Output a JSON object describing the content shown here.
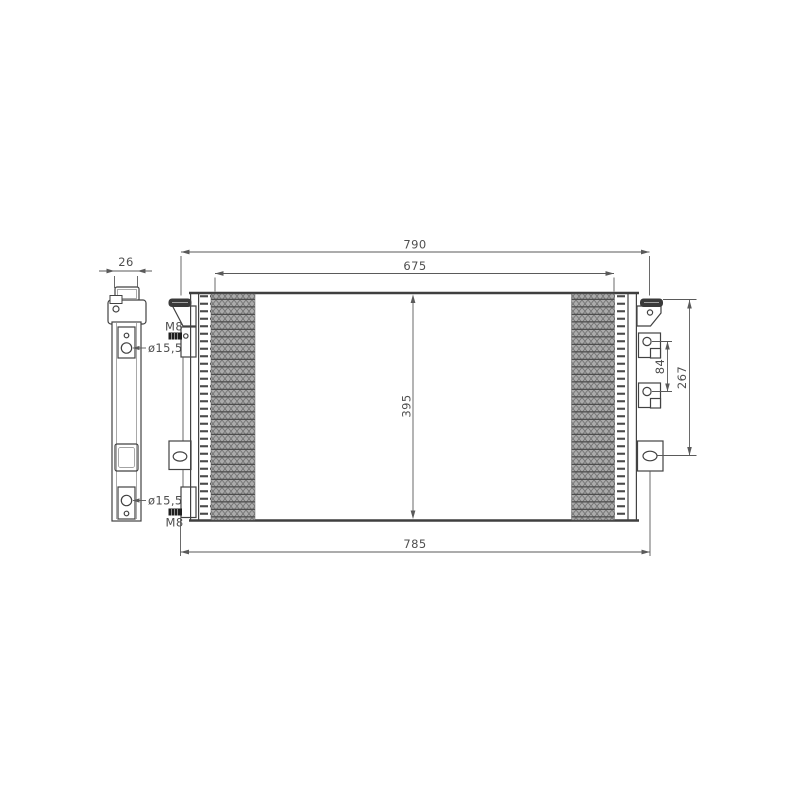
{
  "drawing": {
    "dimensions": {
      "overall_width_top": "790",
      "core_width": "675",
      "side_depth": "26",
      "core_height": "395",
      "port_spacing": "84",
      "bracket_span": "267",
      "overall_width_bottom": "785"
    },
    "labels": {
      "thread_top": "M8",
      "thread_bottom": "M8",
      "port_top": "ø15,5",
      "port_bottom": "ø15,5"
    }
  }
}
